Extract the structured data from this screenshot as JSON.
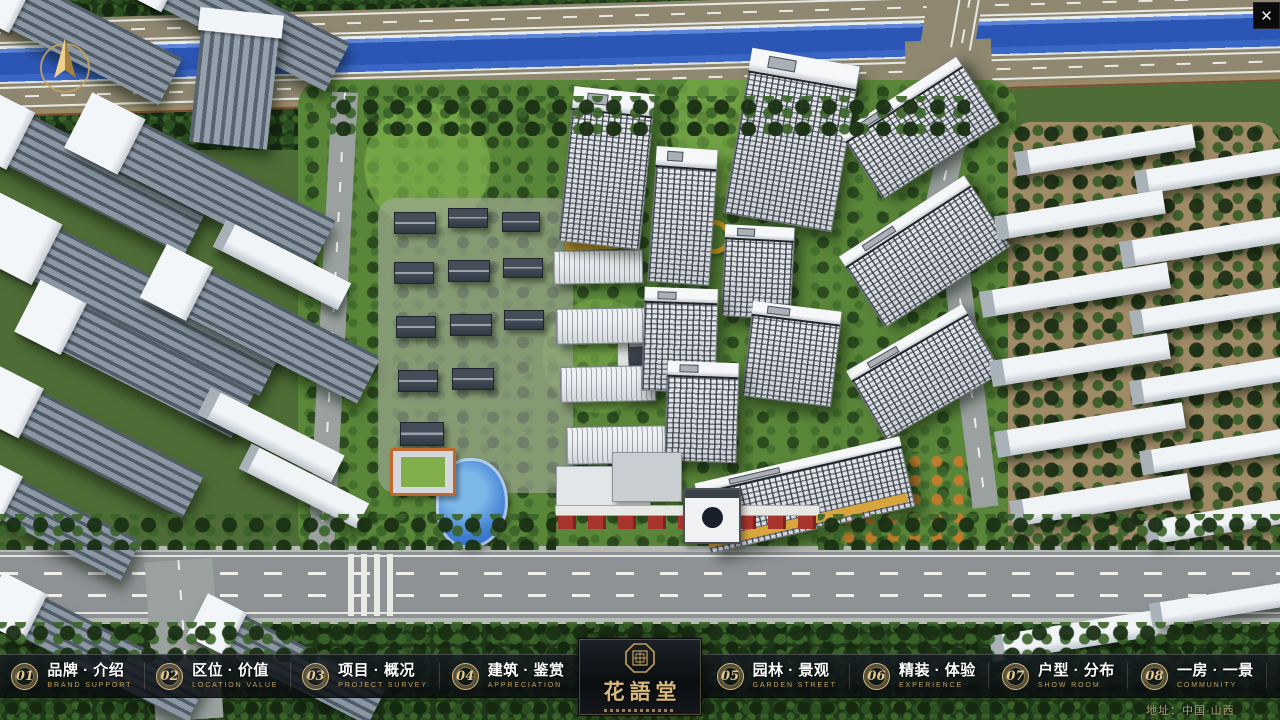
{
  "window": {
    "close_icon_glyph": "✕"
  },
  "nav": {
    "items": [
      {
        "num": "01",
        "cn": "品牌 · 介绍",
        "en": "BRAND SUPPORT"
      },
      {
        "num": "02",
        "cn": "区位 · 价值",
        "en": "LOCATION VALUE"
      },
      {
        "num": "03",
        "cn": "项目 · 概况",
        "en": "PROJECT SURVEY"
      },
      {
        "num": "04",
        "cn": "建筑 · 鉴赏",
        "en": "APPRECIATION"
      },
      {
        "num": "05",
        "cn": "园林 · 景观",
        "en": "GARDEN STREET"
      },
      {
        "num": "06",
        "cn": "精装 · 体验",
        "en": "EXPERIENCE"
      },
      {
        "num": "07",
        "cn": "户型 · 分布",
        "en": "SHOW ROOM"
      },
      {
        "num": "08",
        "cn": "一房 · 一景",
        "en": "COMMUNITY"
      }
    ]
  },
  "logo": {
    "title": "花語堂"
  },
  "footer": {
    "address": "地址：中国·山西"
  },
  "icons": {
    "close": "close-icon",
    "compass": "compass-north-icon",
    "seal": "octagon-seal-icon"
  },
  "colors": {
    "accent_gold": "#C9A96A",
    "bar_background": "rgba(10,14,18,0.84)",
    "river_blue": "#2C56B6",
    "lawn_green": "#6FA03C",
    "road_gray": "#8E9294"
  }
}
